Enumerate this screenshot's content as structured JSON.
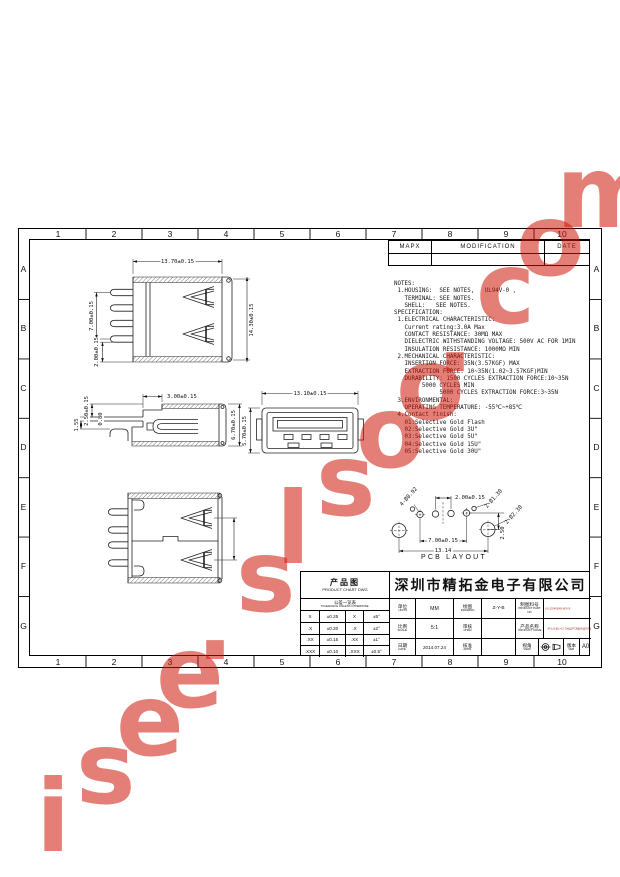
{
  "watermark": {
    "text": "isee.slsoo.com",
    "color": "#cd1608"
  },
  "frame": {
    "cols": [
      "1",
      "2",
      "3",
      "4",
      "5",
      "6",
      "7",
      "8",
      "9",
      "10"
    ],
    "rows": [
      "A",
      "B",
      "C",
      "D",
      "E",
      "F",
      "G"
    ]
  },
  "revision_table": {
    "col1": "MAPX",
    "col2": "MODIFICATION",
    "col3": "DATE"
  },
  "notes": {
    "lines": [
      "NOTES:",
      " 1.HOUSING:  SEE NOTES,   UL94V-0 ,",
      "   TERMINAL: SEE NOTES.",
      "   SHELL:   SEE NOTES.",
      "SPECIFICATION:",
      " 1.ELECTRICAL CHARACTERISTIC:",
      "   Current rating:3.0A Max",
      "   CONTACT RESISTANCE: 30MΩ MAX",
      "   DIELECTRIC WITHSTANDING VOLTAGE: 500V AC FOR 1MIN",
      "   INSULATION RESISTANCE: 1000MΩ MIN",
      " 2.MECHANICAL CHARACTERISTIC:",
      "   INSERTION FORCE: 35N(3.57KGF) MAX",
      "   EXTRACTION FORCE: 10~35N(1.02~3.57KGF)MIN",
      "   DURABILITY: 1500 CYCLES EXTRACTION FORCE:10~35N",
      "        5000 CYCLES MIN",
      "             5000 CYCLES EXTRACTION FORCE:3~35N",
      " 3.ENVIRONMENTAL:",
      "   OPERATING TEMPERATURE: -55℃~+85℃",
      " 4.Contact finish:",
      "   01:Selective Gold Flash",
      "   02:Selective Gold 3U\"",
      "   03:Selective Gold 5U\"",
      "   04:Selective Gold 15U\"",
      "   05:Selective Gold 30U\""
    ]
  },
  "views": {
    "top": {
      "dims": {
        "w": "13.70±0.15",
        "h": "14.30±0.15",
        "span": "7.00±0.15",
        "offset": "2.00±0.15"
      }
    },
    "side": {
      "dims": {
        "depth": "3.00±0.15",
        "d1": "2.50±0.15",
        "d2": "0.80",
        "d3": "1.55",
        "h": "6.70±0.15"
      }
    },
    "front": {
      "dims": {
        "w": "13.10±0.15",
        "h": "5.70±0.15"
      }
    },
    "pcb": {
      "caption": "PCB LAYOUT",
      "dims": {
        "pitch": "2.00±0.15",
        "span": "7.00±0.15",
        "total": "13.14",
        "offset": "2.50",
        "pin_hole": "4-Ø0.92",
        "locating_hole": "2-Ø1.30",
        "shell_hole": "2-Ø2.30"
      }
    }
  },
  "title_block": {
    "product_chart": {
      "zh": "产品图",
      "en": "PRODUCT CHART DWG"
    },
    "company": "深圳市精拓金电子有限公司",
    "tolerance": {
      "header_zh": "公差一览表",
      "header_en": "TOLERANCE UNLESS OTHERWISE",
      "rows": [
        [
          "X",
          "±0.25",
          "X",
          "±5°"
        ],
        [
          ".X",
          "±0.20",
          ".X",
          "±2°"
        ],
        [
          ".XX",
          "±0.15",
          ".XX",
          "±1°"
        ],
        [
          ".XXX",
          "±0.10",
          ".XXX",
          "±0.5°"
        ]
      ]
    },
    "fields": {
      "units_zh": "单位",
      "units_en": "UNITS",
      "units_value": "MM",
      "drawing_zh": "绘图",
      "drawing_en": "DRAWING",
      "drawing_value": "Z-Y-B",
      "part_no_zh": "制图料号",
      "part_no_en": "PRODUCT PART NO",
      "part_no_value": "KU-2024KBXB-WXXX",
      "scale_zh": "比例",
      "scale_en": "SCALE",
      "scale_value": "5:1",
      "chkd_zh": "审核",
      "chkd_en": "CHKD",
      "chkd_value": "",
      "name_zh": "产品名称",
      "name_en": "PRODUCT NAME",
      "name_value": "AF大头型L=13.70固定PCB板90度DIP插板A母(白胶)14",
      "date_zh": "日期",
      "date_en": "DATE",
      "date_value": "2014.07.24",
      "appd_zh": "核准",
      "appd_en": "APPD",
      "appd_value": "",
      "view_zh": "视角",
      "view_en": "VIEW",
      "ver_zh": "版本",
      "ver_en": "VER",
      "ver_value": "A0"
    }
  }
}
